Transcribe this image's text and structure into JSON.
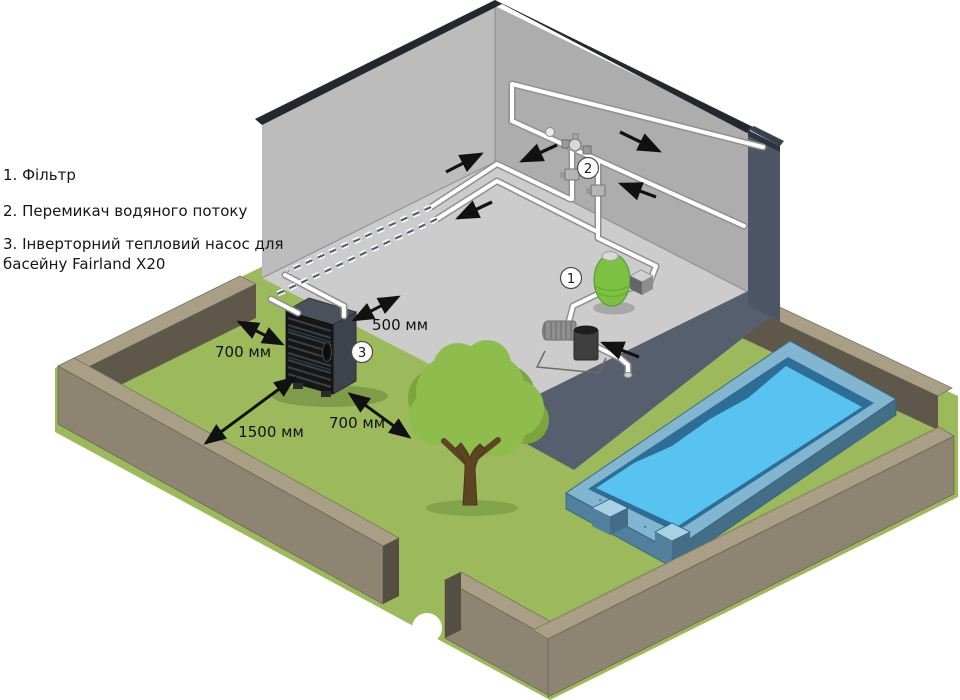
{
  "legend": {
    "item1": "1. Фільтр",
    "item2": "2. Перемикач водяного потоку",
    "item3_line1": "3. Інверторний тепловий насос для",
    "item3_line2": "басейну Fairland X20"
  },
  "badges": {
    "filter": "1",
    "flow_switch": "2",
    "heat_pump": "3"
  },
  "dimensions": {
    "wall_clearance": "500 мм",
    "side_clearance": "700 мм",
    "front_clearance": "1500 мм",
    "right_clearance": "700 мм"
  },
  "colors": {
    "grass": "#9cba5c",
    "water": "#58c3f0",
    "exterior_wall": "#575f6e",
    "interior_wall": "#b9b9b9",
    "fence": "#8d8472",
    "filter_tank": "#7cc142",
    "pipe": "#ffffff"
  }
}
